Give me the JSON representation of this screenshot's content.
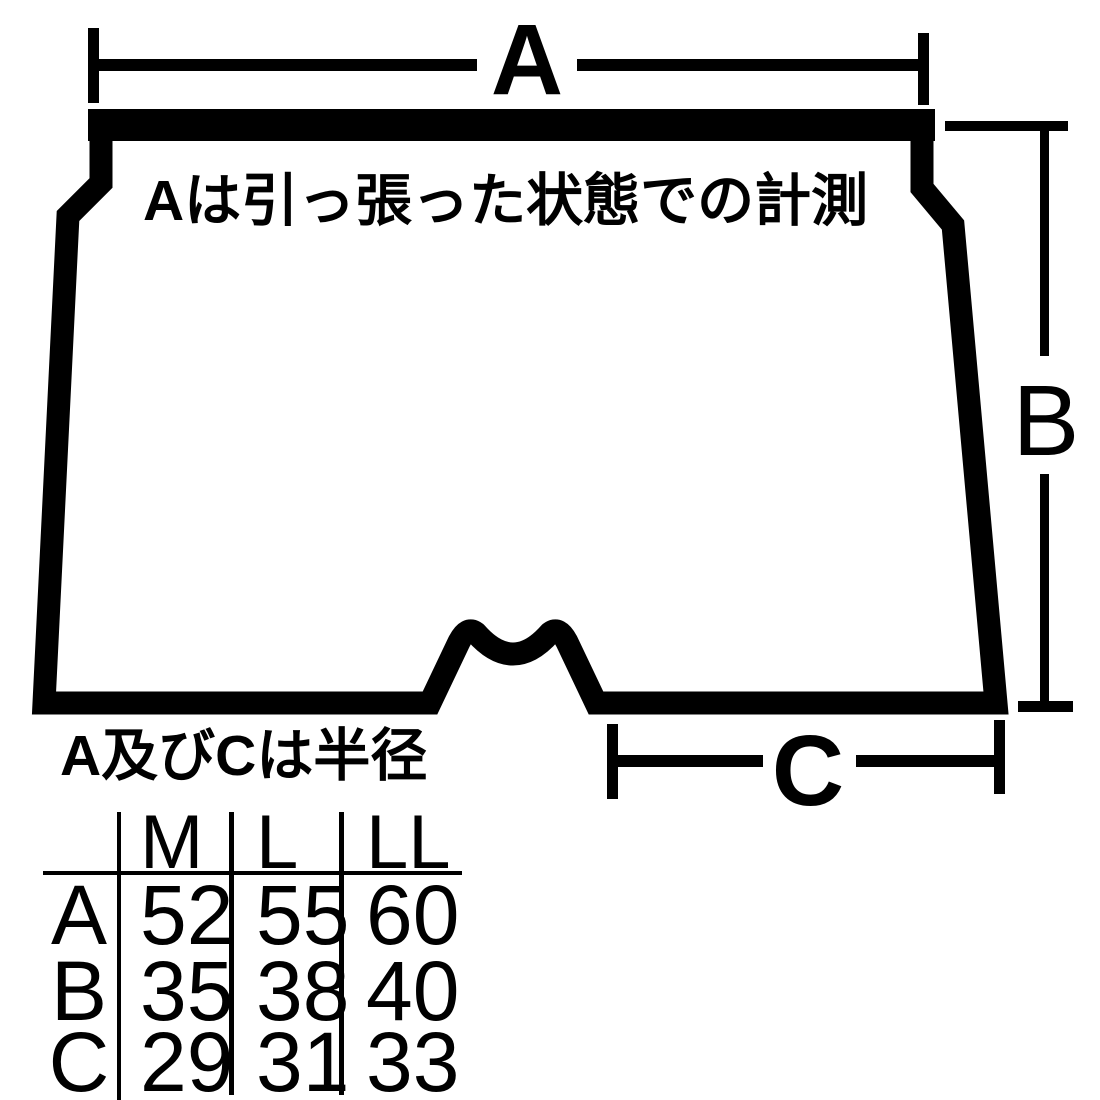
{
  "diagram": {
    "dimension_labels": {
      "a": "A",
      "b": "B",
      "c": "C"
    },
    "note_top": "Aは引っ張った状態での計測",
    "note_bottom": "A及びCは半径"
  },
  "size_table": {
    "columns": [
      "M",
      "L",
      "LL"
    ],
    "rows": [
      {
        "label": "A",
        "values": [
          "52",
          "55",
          "60"
        ]
      },
      {
        "label": "B",
        "values": [
          "35",
          "38",
          "40"
        ]
      },
      {
        "label": "C",
        "values": [
          "29",
          "31",
          "33"
        ]
      }
    ]
  },
  "colors": {
    "ink": "#000000",
    "background": "#ffffff"
  }
}
